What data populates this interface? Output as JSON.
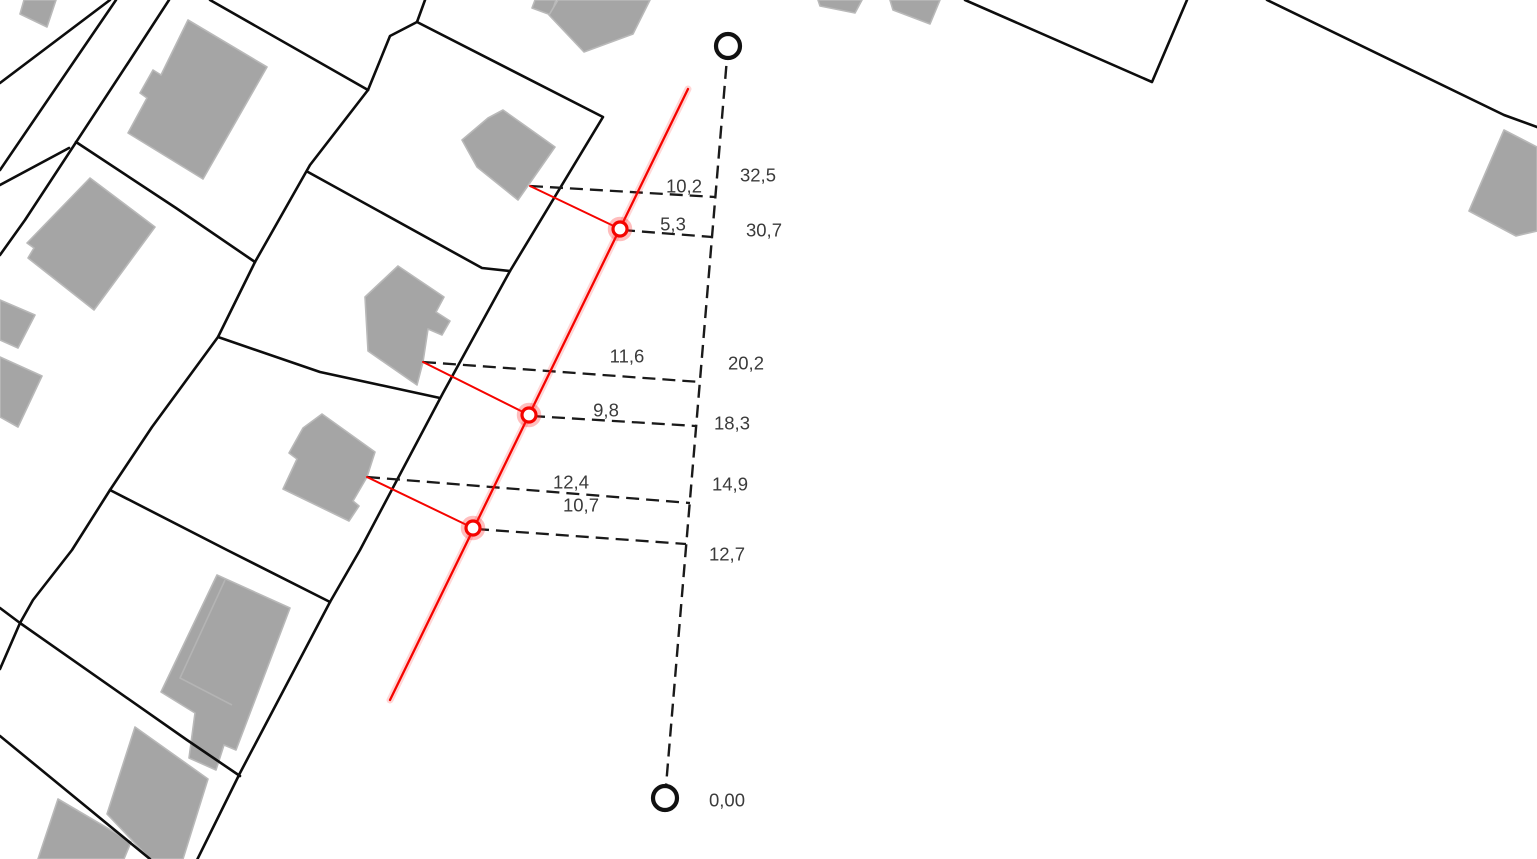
{
  "map": {
    "title": "cadastral-survey-sketch",
    "background": "#ffffff",
    "colors": {
      "parcel_line": "#0d0d0d",
      "building_fill": "#a5a5a5",
      "building_stroke": "#b9b9b9",
      "survey_red": "#f50400",
      "dashed_black": "#1a1a1a",
      "label_color": "#3b3b3b"
    },
    "buildings": [
      {
        "name": "building-top-left-corner",
        "points": "24,0 56,0 47,27 20,14"
      },
      {
        "name": "building-nw-large",
        "points": "188,20 267,67 203,179 128,133 147,98 140,93 153,70 161,75"
      },
      {
        "name": "building-nw-lower",
        "points": "90,178 155,227 94,310 28,258 34,248 27,243"
      },
      {
        "name": "building-west-edge-upper",
        "points": "0,300 35,315 18,348 0,340"
      },
      {
        "name": "building-west-edge-lower",
        "points": "0,357 42,376 18,427 0,417"
      },
      {
        "name": "building-top-center-annex",
        "points": "535,0 556,0 551,15 532,8"
      },
      {
        "name": "building-top-center",
        "points": "558,0 650,0 633,34 584,52 549,15"
      },
      {
        "name": "building-top-right-a",
        "points": "818,0 862,0 855,13 820,6"
      },
      {
        "name": "building-top-right-b",
        "points": "890,0 940,0 930,24 893,10"
      },
      {
        "name": "building-row-north",
        "points": "503,110 555,147 518,200 477,167 462,140 488,118"
      },
      {
        "name": "building-row-middle",
        "points": "398,266 444,297 436,312 450,321 442,335 428,329 423,362 417,385 368,351 365,297"
      },
      {
        "name": "building-row-south",
        "points": "322,414 375,452 367,477 353,501 359,506 349,521 283,489 297,459 289,453 303,428"
      },
      {
        "name": "building-south-tall",
        "points": "217,575 290,608 236,750 224,745 216,770 189,758 195,713 161,692"
      },
      {
        "name": "building-south-l",
        "points": "135,727 208,779 183,859 150,859 107,814"
      },
      {
        "name": "building-sw-corner",
        "points": "58,799 131,842 124,859 38,859"
      },
      {
        "name": "building-far-east",
        "points": "1504,130 1537,147 1537,231 1516,236 1469,211"
      }
    ],
    "building_details": [
      {
        "name": "building-south-tall-roofline",
        "points": "225,580 180,678 232,705"
      }
    ],
    "parcel_lines": [
      {
        "points": "110,0 0,83"
      },
      {
        "points": "116,0 75,60 0,170"
      },
      {
        "points": "169,0 130,60 25,220 0,255"
      },
      {
        "points": "69,148 0,185"
      },
      {
        "points": "76,142 176,208 255,262"
      },
      {
        "points": "210,0 368,90"
      },
      {
        "points": "368,90 310,165 255,262 218,337 152,427 110,490 72,550 33,600 20,623 0,669"
      },
      {
        "points": "0,608 20,623"
      },
      {
        "points": "308,172 482,268 510,271"
      },
      {
        "points": "218,337 320,372 440,398"
      },
      {
        "points": "110,490 227,550 330,602"
      },
      {
        "points": "20,623 187,740 240,776"
      },
      {
        "points": "425,0 417,22 603,117 510,271 443,393 360,550 330,602 240,773 197,860"
      },
      {
        "points": "417,22 390,36 368,90"
      },
      {
        "points": "0,736 150,859"
      },
      {
        "points": "965,0 1152,82 1187,0"
      },
      {
        "points": "1267,0 1504,115 1537,127"
      }
    ],
    "baseline": {
      "line": "728,46 665,798",
      "endpoints": [
        {
          "cx": 728,
          "cy": 46,
          "r": 12
        },
        {
          "cx": 665,
          "cy": 798,
          "r": 12
        }
      ]
    },
    "stations": [
      {
        "text": "32,5",
        "x": 758,
        "y": 175
      },
      {
        "text": "30,7",
        "x": 764,
        "y": 230
      },
      {
        "text": "20,2",
        "x": 746,
        "y": 363
      },
      {
        "text": "18,3",
        "x": 732,
        "y": 423
      },
      {
        "text": "14,9",
        "x": 730,
        "y": 484
      },
      {
        "text": "12,7",
        "x": 727,
        "y": 554
      },
      {
        "text": "0,00",
        "x": 727,
        "y": 800
      }
    ],
    "offsets": [
      {
        "text": "10,2",
        "label": {
          "x": 684,
          "y": 186
        },
        "line": "530,186 715,197"
      },
      {
        "text": "5,3",
        "label": {
          "x": 673,
          "y": 224
        },
        "line": "622,230 712,237"
      },
      {
        "text": "11,6",
        "label": {
          "x": 627,
          "y": 356
        },
        "line": "423,362 700,382"
      },
      {
        "text": "9,8",
        "label": {
          "x": 606,
          "y": 410
        },
        "line": "532,416 696,426"
      },
      {
        "text": "12,4",
        "label": {
          "x": 571,
          "y": 482
        },
        "line": "367,477 690,503"
      },
      {
        "text": "10,7",
        "label": {
          "x": 581,
          "y": 505
        },
        "line": "476,529 686,544"
      }
    ],
    "survey": {
      "main_line": "688,89 390,700",
      "ties": [
        {
          "points": "530,186 620,229"
        },
        {
          "points": "423,362 529,415"
        },
        {
          "points": "367,477 473,528"
        }
      ],
      "points": [
        {
          "cx": 620,
          "cy": 229
        },
        {
          "cx": 529,
          "cy": 415
        },
        {
          "cx": 473,
          "cy": 528
        }
      ]
    }
  }
}
